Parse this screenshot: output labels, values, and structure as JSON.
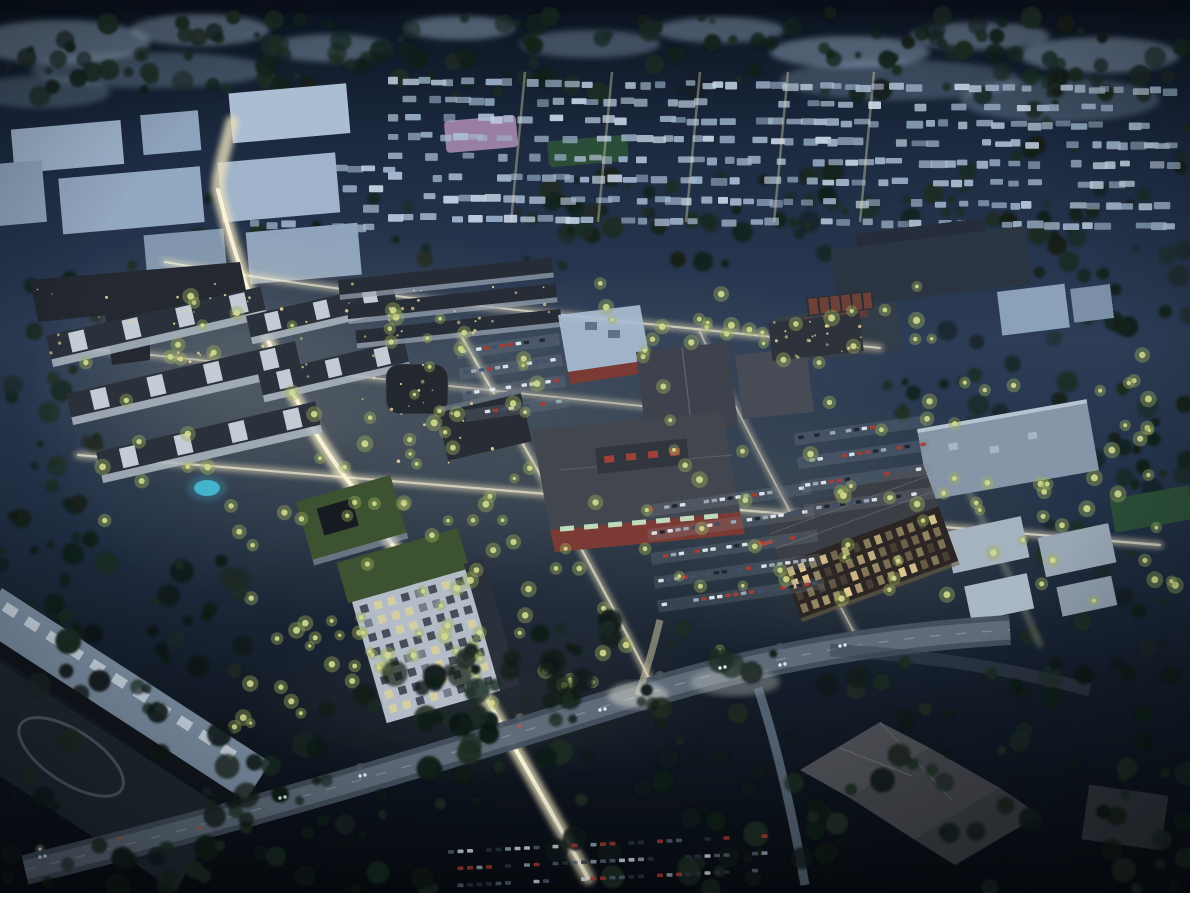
{
  "scene": {
    "type": "architectural-aerial-rendering",
    "time_of_day": "dusk",
    "alt": "Aerial rendering at dusk of a master-planned mixed-use development",
    "description": "Nighttime aerial rendering of a large mixed-use redevelopment: a warmly lit tilted street grid with glowing trees, courtyard apartment blocks with a swimming pool, big-box retail stores with red brick walls and a light blue roof, parking lots full of cars, a mid-rise office building with lit windows, high-rise residential towers with green roofs, an industrial building at lower left, an arterial road with car headlights in the foreground, dark tree canopy throughout, and pale blue suburban rooftops stretching to the horizon."
  },
  "palette": {
    "sky-top": "#0a121d",
    "dusk-high": "#1d2b42",
    "dusk-mid": "#2d3d56",
    "dusk-low": "#1f2c40",
    "ground-dark": "#0d131c",
    "night-black": "#070b10",
    "tree-dark": "#13201a",
    "tree-mid": "#1c2b22",
    "tree-lit": "#9fb25c",
    "tree-lit-core": "#d4dc8e",
    "roof-pale": "#9db3cb",
    "roof-light": "#aabdd3",
    "facade-light": "#b4bdc7",
    "roof-slate": "#3d424c",
    "roof-dark": "#272d36",
    "wall-red": "#7b3a33",
    "street-glow": "#e9dfbc",
    "street-core": "#fdf6dd",
    "window-warm": "#e8d197",
    "pool-blue": "#45b8d1",
    "road-asphalt": "#4a5662",
    "road-light": "#6b7885",
    "car-white": "#e8eef4",
    "car-red": "#b03a31",
    "field-pink": "#b995bb",
    "field-green": "#2d5238",
    "grass-roof": "#3c5230",
    "brick-dark": "#6d4038",
    "glow-green": "#c8eccc"
  },
  "regions": [
    {
      "name": "distant-terrain",
      "description": "Pale blue-gray distant landscape patches along the horizon"
    },
    {
      "name": "suburban-rooftops",
      "description": "Rows of pale blue suburban rooftops with lit cross streets"
    },
    {
      "name": "pink-field",
      "description": "Small pink-lavender field among distant houses"
    },
    {
      "name": "sports-field",
      "description": "Dark green playing field near the distant houses"
    },
    {
      "name": "office-park-north-west",
      "description": "Cluster of pale flat-roofed office boxes at upper left"
    },
    {
      "name": "office-slabs-north-east",
      "description": "Large dark flat-roofed office buildings at upper right"
    },
    {
      "name": "street-grid",
      "description": "Warmly lit tilted street grid of the new development"
    },
    {
      "name": "main-avenue",
      "description": "Bright main avenue running from upper left to bottom center"
    },
    {
      "name": "residential-courtyard-blocks",
      "description": "Apartment rows with lit courtyards on the left"
    },
    {
      "name": "swimming-pool",
      "description": "Small cyan swimming pool in a courtyard"
    },
    {
      "name": "blue-roof-store",
      "description": "Big-box store with light blue roof and red brick walls"
    },
    {
      "name": "warehouse-roofs",
      "description": "Dark slate warehouse roofs in the retail core"
    },
    {
      "name": "red-brick-store",
      "description": "Large store with gray roof, roof monitor and red brick walls with glowing storefronts"
    },
    {
      "name": "office-tower",
      "description": "Mid-rise office building with grid of warm lit windows"
    },
    {
      "name": "retail-pads-east",
      "description": "Light-roofed retail pad buildings on the east side"
    },
    {
      "name": "residential-towers",
      "description": "High-rise residential towers with green roofs and lit facades"
    },
    {
      "name": "industrial-building-south-west",
      "description": "Long industrial building with skylight roof and dark parking lot"
    },
    {
      "name": "arterial-road",
      "description": "Wide arterial road with car headlights crossing the foreground"
    },
    {
      "name": "house-complex-south-east",
      "description": "Existing hip-roofed building complex among dark trees at lower right"
    },
    {
      "name": "parking-lots",
      "description": "Parking lots with rows of parked cars"
    },
    {
      "name": "tree-canopy",
      "description": "Dark teal tree canopy and glowing street trees"
    }
  ]
}
